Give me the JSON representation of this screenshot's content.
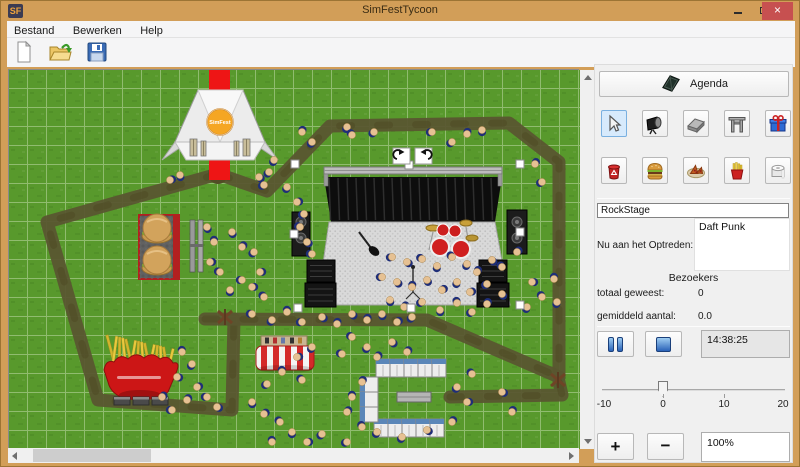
{
  "window": {
    "title": "SimFestTycoon",
    "icon_text": "SF"
  },
  "menu": {
    "items": [
      "Bestand",
      "Bewerken",
      "Help"
    ]
  },
  "toolbar": {
    "buttons": [
      "new-document",
      "open-file",
      "save-file"
    ]
  },
  "sidebar": {
    "agenda_label": "Agenda",
    "tools_row1": [
      "select-cursor",
      "stage-light",
      "path-tile",
      "entrance-gate",
      "gift"
    ],
    "tools_row2": [
      "trash-can",
      "hamburger",
      "pizza",
      "fries",
      "toilet-roll"
    ],
    "selected_tool": "select-cursor",
    "stage_name_value": "RockStage",
    "now_playing_label": "Nu aan het Optreden:",
    "now_playing_value": "Daft Punk",
    "visitors_header": "Bezoekers",
    "total_label": "totaal geweest:",
    "total_value": "0",
    "avg_label": "gemiddeld aantal:",
    "avg_value": "0.0",
    "time_value": "14:38:25",
    "slider": {
      "min": -10,
      "max": 20,
      "value": 0,
      "ticks": [
        "-10",
        "0",
        "10",
        "20"
      ]
    },
    "zoom_plus": "+",
    "zoom_minus": "−",
    "zoom_level": "100%"
  },
  "colors": {
    "titlebar": "#d29e58",
    "close": "#c75050",
    "grass": "#58992c",
    "path": "#5a5630",
    "carpet": "#ee1515",
    "selected_tool_bg": "#d7eafc"
  },
  "map": {
    "logo_text": "SimFest",
    "grid_cell": 19,
    "paths": [
      [
        [
          209,
          104
        ],
        [
          258,
          121
        ],
        [
          321,
          56
        ],
        [
          500,
          53
        ],
        [
          550,
          92
        ],
        [
          550,
          304
        ]
      ],
      [
        [
          209,
          104
        ],
        [
          38,
          152
        ],
        [
          89,
          330
        ],
        [
          223,
          340
        ],
        [
          225,
          249
        ]
      ],
      [
        [
          196,
          249
        ],
        [
          418,
          250
        ],
        [
          550,
          307
        ]
      ],
      [
        [
          550,
          312
        ],
        [
          553,
          325
        ],
        [
          441,
          327
        ]
      ]
    ],
    "carpet": {
      "x": 200,
      "y": 0,
      "w": 21,
      "h": 110
    },
    "junction": {
      "x": 209,
      "y": 104,
      "r": 10
    },
    "dead_trees": [
      [
        216,
        247
      ],
      [
        549,
        310
      ]
    ],
    "handles": [
      [
        286,
        94
      ],
      [
        400,
        95
      ],
      [
        511,
        94
      ],
      [
        285,
        164
      ],
      [
        511,
        162
      ],
      [
        289,
        238
      ],
      [
        402,
        238
      ],
      [
        511,
        235
      ]
    ],
    "rotate_buttons": [
      [
        384,
        78
      ],
      [
        406,
        78
      ]
    ],
    "people": [
      [
        293,
        62
      ],
      [
        303,
        72
      ],
      [
        338,
        57
      ],
      [
        343,
        65
      ],
      [
        365,
        62
      ],
      [
        423,
        62
      ],
      [
        443,
        72
      ],
      [
        458,
        64
      ],
      [
        473,
        60
      ],
      [
        250,
        107
      ],
      [
        255,
        115
      ],
      [
        260,
        102
      ],
      [
        265,
        90
      ],
      [
        278,
        117
      ],
      [
        161,
        110
      ],
      [
        171,
        105
      ],
      [
        288,
        132
      ],
      [
        295,
        144
      ],
      [
        291,
        157
      ],
      [
        298,
        172
      ],
      [
        303,
        184
      ],
      [
        198,
        157
      ],
      [
        205,
        172
      ],
      [
        201,
        192
      ],
      [
        211,
        202
      ],
      [
        223,
        162
      ],
      [
        233,
        177
      ],
      [
        245,
        182
      ],
      [
        251,
        202
      ],
      [
        233,
        210
      ],
      [
        221,
        220
      ],
      [
        243,
        217
      ],
      [
        255,
        227
      ],
      [
        243,
        244
      ],
      [
        263,
        250
      ],
      [
        278,
        242
      ],
      [
        293,
        252
      ],
      [
        313,
        247
      ],
      [
        328,
        254
      ],
      [
        343,
        244
      ],
      [
        358,
        250
      ],
      [
        373,
        244
      ],
      [
        388,
        252
      ],
      [
        403,
        247
      ],
      [
        383,
        187
      ],
      [
        398,
        192
      ],
      [
        413,
        189
      ],
      [
        428,
        196
      ],
      [
        443,
        187
      ],
      [
        458,
        194
      ],
      [
        468,
        202
      ],
      [
        483,
        190
      ],
      [
        493,
        197
      ],
      [
        373,
        207
      ],
      [
        388,
        212
      ],
      [
        403,
        217
      ],
      [
        418,
        210
      ],
      [
        433,
        220
      ],
      [
        448,
        212
      ],
      [
        461,
        222
      ],
      [
        478,
        214
      ],
      [
        493,
        224
      ],
      [
        381,
        230
      ],
      [
        395,
        237
      ],
      [
        413,
        232
      ],
      [
        431,
        240
      ],
      [
        448,
        233
      ],
      [
        463,
        242
      ],
      [
        478,
        234
      ],
      [
        523,
        212
      ],
      [
        533,
        227
      ],
      [
        518,
        237
      ],
      [
        508,
        182
      ],
      [
        526,
        94
      ],
      [
        533,
        112
      ],
      [
        343,
        267
      ],
      [
        358,
        277
      ],
      [
        333,
        284
      ],
      [
        368,
        287
      ],
      [
        383,
        272
      ],
      [
        398,
        282
      ],
      [
        303,
        277
      ],
      [
        288,
        287
      ],
      [
        273,
        302
      ],
      [
        293,
        310
      ],
      [
        258,
        314
      ],
      [
        173,
        282
      ],
      [
        183,
        294
      ],
      [
        168,
        307
      ],
      [
        188,
        317
      ],
      [
        198,
        327
      ],
      [
        178,
        330
      ],
      [
        208,
        337
      ],
      [
        163,
        340
      ],
      [
        153,
        327
      ],
      [
        353,
        312
      ],
      [
        343,
        327
      ],
      [
        338,
        342
      ],
      [
        353,
        357
      ],
      [
        368,
        362
      ],
      [
        393,
        367
      ],
      [
        418,
        360
      ],
      [
        443,
        352
      ],
      [
        458,
        332
      ],
      [
        448,
        317
      ],
      [
        463,
        304
      ],
      [
        493,
        322
      ],
      [
        503,
        342
      ],
      [
        338,
        372
      ],
      [
        243,
        332
      ],
      [
        255,
        344
      ],
      [
        271,
        352
      ],
      [
        283,
        362
      ],
      [
        298,
        372
      ],
      [
        313,
        364
      ],
      [
        263,
        372
      ],
      [
        545,
        209
      ],
      [
        548,
        232
      ]
    ]
  }
}
